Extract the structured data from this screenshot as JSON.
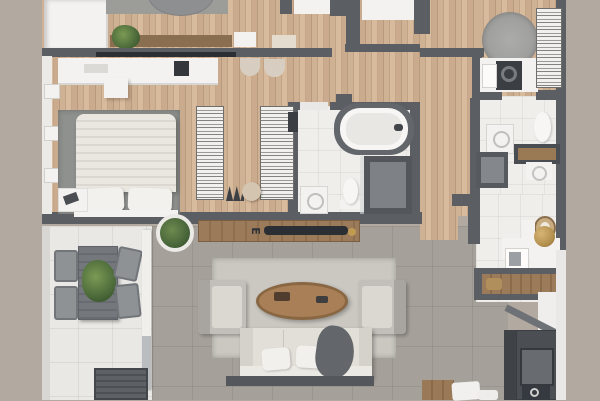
{
  "scene": "3d-apartment-floor-plan-top-view",
  "decor": {
    "console_letter": "E"
  },
  "palette": {
    "background": "#b2a9a1",
    "wall": "#5b5f64",
    "wood_floor": "#cbab8d",
    "living_tile": "#a6a09a",
    "balcony_tile": "#e9e8e4",
    "bathroom_tile": "#efeeeb",
    "furniture_white": "#f3f2f0",
    "furniture_dark": "#4b4f54",
    "wood_furniture": "#9b7b59",
    "plant_green": "#5d7a45",
    "brass_accent": "#b5914f"
  },
  "rooms": [
    {
      "name": "bedroom"
    },
    {
      "name": "walk-in-closet"
    },
    {
      "name": "bathroom-main"
    },
    {
      "name": "bathroom-ensuite"
    },
    {
      "name": "laundry-nook"
    },
    {
      "name": "hallway"
    },
    {
      "name": "entry"
    },
    {
      "name": "kitchen"
    },
    {
      "name": "living-room"
    },
    {
      "name": "balcony"
    }
  ]
}
